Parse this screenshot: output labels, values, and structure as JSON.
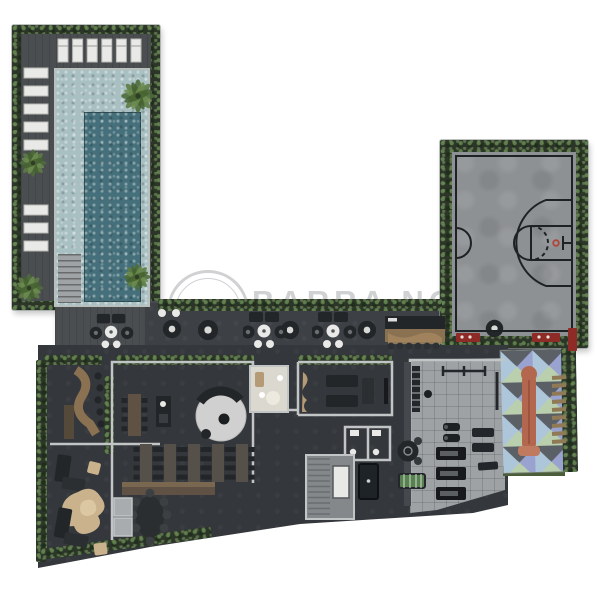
{
  "watermark": {
    "initials": "BN",
    "line1": "BARRA NORTE",
    "line2": "IMÓVEIS"
  },
  "colors": {
    "floor_dark": "#3d4045",
    "floor_interior": "#34373b",
    "deck": "#4b4e51",
    "hedge": "#2c3628",
    "pool_shallow": "#a9c0c3",
    "pool_deep": "#45707b",
    "coping": "#b9bfbc",
    "court": "#8e9194",
    "court_line": "#1f2224",
    "wall_line": "#c2c5c6",
    "gym_floor": "#9fa2a5",
    "wood": "#8a7152",
    "wood_dark": "#5f5244",
    "sand": "#c9b28c",
    "red_accent": "#8e2b26",
    "furn_dark": "#232629",
    "furn_white": "#e9e9e7",
    "rug_light": "#cfd0cf",
    "room_light": "#dbd8cf",
    "grass": "#4c5d3a",
    "foosball": "#57824f",
    "slide": "#b4674f",
    "stairs_floor": "#85888b",
    "palm": "#4e6b3b",
    "watermark_color": "rgba(168,171,173,0.55)"
  },
  "kids_palette": [
    "#9aa3cf",
    "#b9cfae",
    "#aec6da",
    "#5a6066",
    "#d3bcc8",
    "#e3e0d2"
  ]
}
